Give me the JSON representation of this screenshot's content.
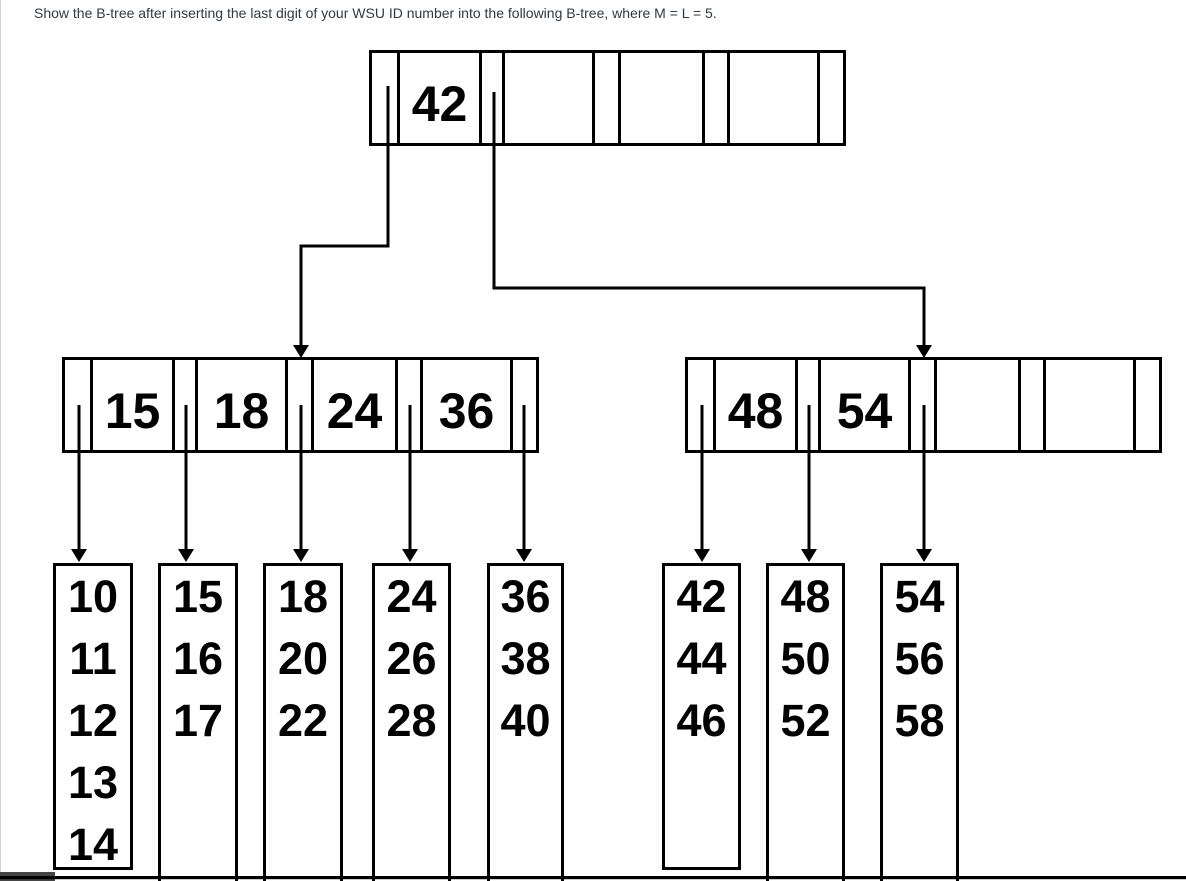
{
  "title": "Show the B-tree after inserting the last digit of your WSU ID number into the following B-tree, where M = L = 5.",
  "tree": {
    "order_note": "M = L = 5",
    "root": {
      "keys": [
        "42",
        "",
        "",
        ""
      ]
    },
    "internals": [
      {
        "keys": [
          "15",
          "18",
          "24",
          "36"
        ]
      },
      {
        "keys": [
          "48",
          "54",
          "",
          ""
        ]
      }
    ],
    "leaves": [
      {
        "values": [
          "10",
          "11",
          "12",
          "13",
          "14"
        ]
      },
      {
        "values": [
          "15",
          "16",
          "17",
          "",
          ""
        ]
      },
      {
        "values": [
          "18",
          "20",
          "22",
          "",
          ""
        ]
      },
      {
        "values": [
          "24",
          "26",
          "28",
          "",
          ""
        ]
      },
      {
        "values": [
          "36",
          "38",
          "40",
          "",
          ""
        ]
      },
      {
        "values": [
          "42",
          "44",
          "46",
          "",
          ""
        ]
      },
      {
        "values": [
          "48",
          "50",
          "52",
          "",
          ""
        ]
      },
      {
        "values": [
          "54",
          "56",
          "58",
          "",
          ""
        ]
      }
    ]
  },
  "colors": {
    "line": "#000000",
    "title_text": "#2d3b45",
    "page_border": "#ccd1d7",
    "bottom_bar": "#454545",
    "background": "#ffffff"
  }
}
